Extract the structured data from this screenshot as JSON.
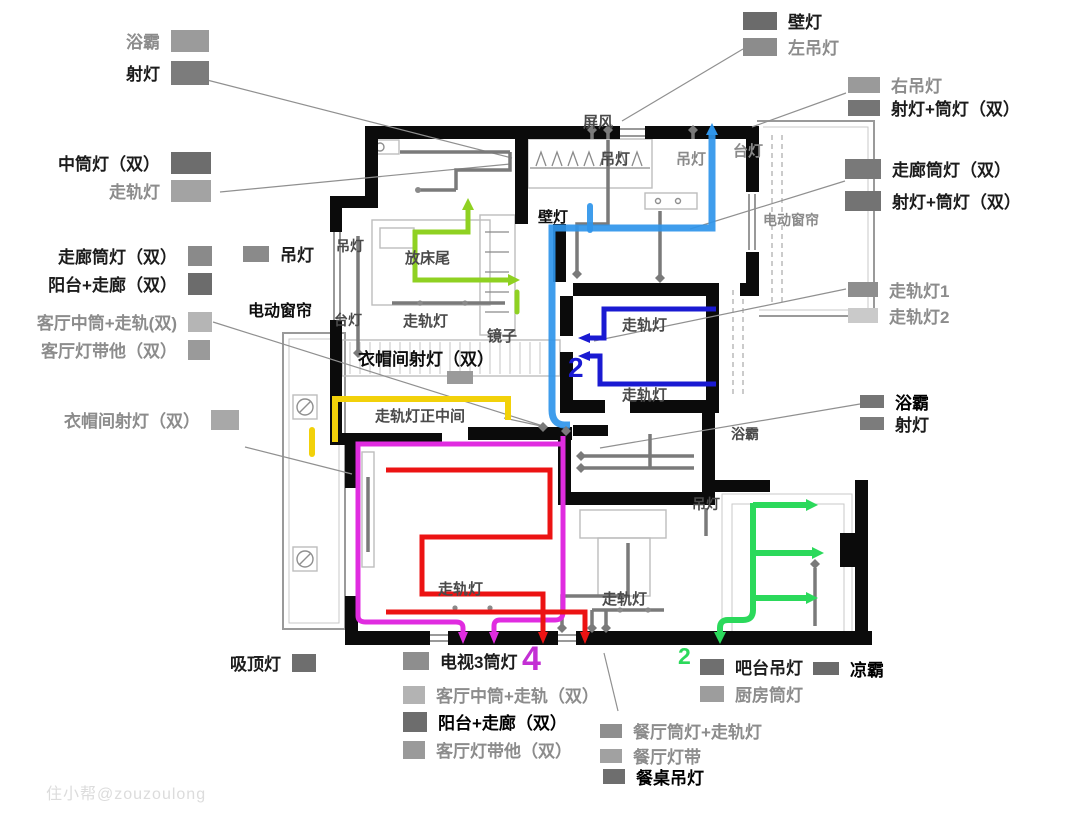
{
  "watermark": "住小帮@zouzoulong",
  "numbers": {
    "living_exit": "4",
    "study": "2",
    "kitchen": "2"
  },
  "colors": {
    "blue": "#2f95ea",
    "dark_blue": "#1a1ad2",
    "green": "#2bd95b",
    "yellow_green": "#8fd122",
    "yellow": "#f2d10a",
    "magenta": "#e02ce0",
    "red": "#ec1313",
    "wire_gray": "#7a7a7a",
    "wall_black": "#0b0b0b"
  },
  "legend": {
    "bath_tl": {
      "label": "浴霸",
      "color": "#9b9b9b"
    },
    "spot_tl": {
      "label": "射灯",
      "color": "#7c7c7c"
    },
    "mid_downlight": {
      "label": "中筒灯（双）",
      "color": "#6d6d6d"
    },
    "track_l": {
      "label": "走轨灯",
      "color": "#a3a3a3"
    },
    "corridor_down_l": {
      "label": "走廊筒灯（双）",
      "color": "#8a8a8a"
    },
    "balcony_corridor_l": {
      "label": "阳台+走廊（双）",
      "color": "#6c6c6c"
    },
    "living_mid_track_l": {
      "label": "客厅中筒+走轨(双)",
      "color": "#b5b5b5"
    },
    "living_strip_l": {
      "label": "客厅灯带他（双）",
      "color": "#9a9a9a"
    },
    "closet_spot_l": {
      "label": "衣帽间射灯（双）",
      "color": "#a8a8a8"
    },
    "pendant_l": {
      "label": "吊灯",
      "color": "#8a8a8a"
    },
    "ceiling": {
      "label": "吸顶灯",
      "color": "#6e6e6e"
    },
    "wall_lamp": {
      "label": "壁灯",
      "color": "#6b6b6b"
    },
    "left_pendant": {
      "label": "左吊灯",
      "color": "#8c8c8c"
    },
    "right_pendant": {
      "label": "右吊灯",
      "color": "#9a9a9a"
    },
    "spot_down_tr": {
      "label": "射灯+筒灯（双）",
      "color": "#757575"
    },
    "corridor_down_r": {
      "label": "走廊筒灯（双）",
      "color": "#797979"
    },
    "spot_down_r": {
      "label": "射灯+筒灯（双）",
      "color": "#737373"
    },
    "track1": {
      "label": "走轨灯1",
      "color": "#8e8e8e"
    },
    "track2": {
      "label": "走轨灯2",
      "color": "#cacaca"
    },
    "bath_r": {
      "label": "浴霸",
      "color": "#757575"
    },
    "spot_r": {
      "label": "射灯",
      "color": "#7c7c7c"
    },
    "tv3": {
      "label": "电视3筒灯",
      "color": "#8e8e8e"
    },
    "living_mid_track_b": {
      "label": "客厅中筒+走轨（双）",
      "color": "#b3b3b3"
    },
    "balcony_corridor_b": {
      "label": "阳台+走廊（双）",
      "color": "#6d6d6d"
    },
    "living_strip_b": {
      "label": "客厅灯带他（双）",
      "color": "#9a9a9a"
    },
    "bar_pendant": {
      "label": "吧台吊灯",
      "color": "#6f6f6f"
    },
    "cool": {
      "label": "凉霸",
      "color": "#6b6b6b"
    },
    "kitchen_down": {
      "label": "厨房筒灯",
      "color": "#9d9d9d"
    },
    "dining_down_track": {
      "label": "餐厅筒灯+走轨灯",
      "color": "#8f8f8f"
    },
    "dining_strip": {
      "label": "餐厅灯带",
      "color": "#a1a1a1"
    },
    "dining_pendant": {
      "label": "餐桌吊灯",
      "color": "#6e6e6e"
    }
  },
  "plan_labels": {
    "screen": "屏风",
    "pendant_top1": "吊灯",
    "pendant_top2": "吊灯",
    "lamp_tr": "台灯",
    "wall_lamp": "壁灯",
    "curtain_r": "电动窗帘",
    "pendant_bed2": "吊灯",
    "bed_end": "放床尾",
    "lamp_bed2": "台灯",
    "track_bed2": "走轨灯",
    "mirror": "镜子",
    "closet_spot": "衣帽间射灯（双）",
    "curtain_l": "电动窗帘",
    "track_center": "走轨灯正中间",
    "track_study1": "走轨灯",
    "track_study2": "走轨灯",
    "track_living": "走轨灯",
    "track_dining": "走轨灯",
    "bath": "浴霸",
    "pendant_dining": "吊灯"
  }
}
